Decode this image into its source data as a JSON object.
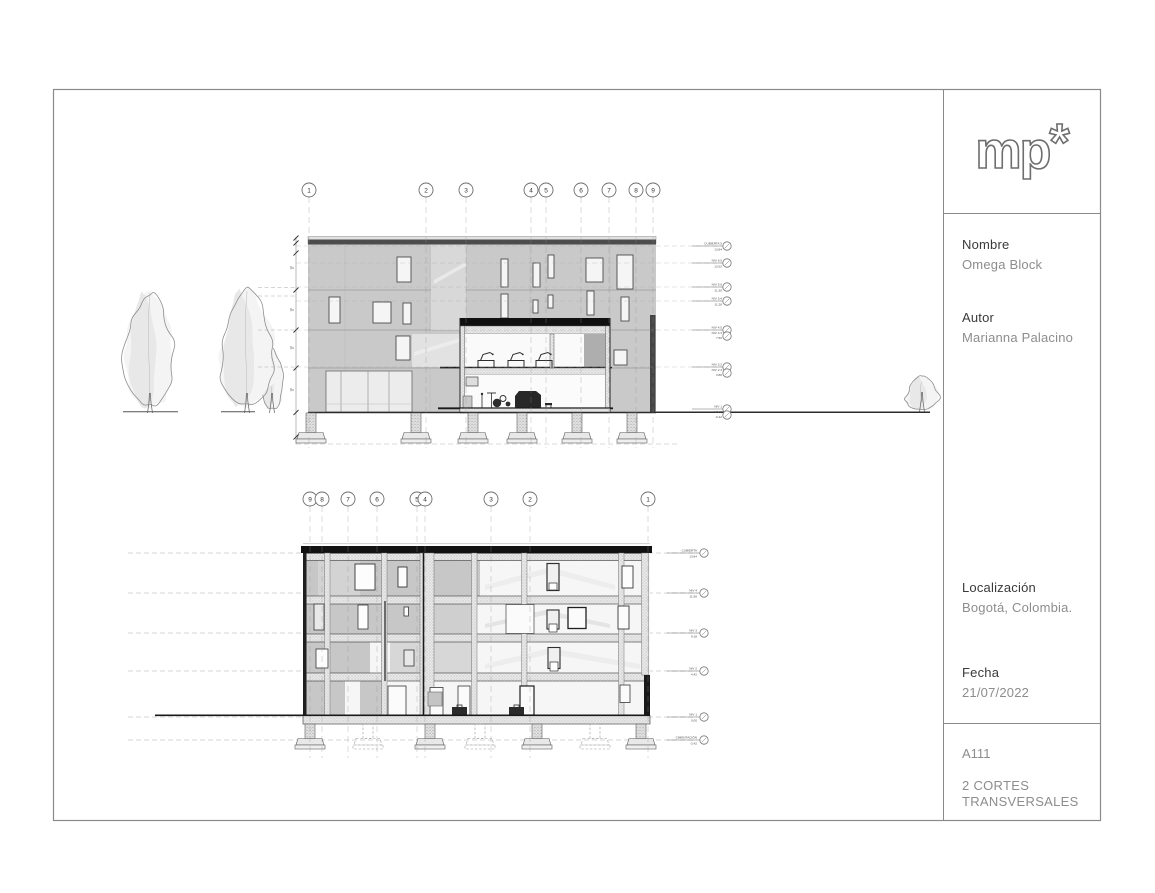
{
  "title_block": {
    "logo_text": "mp",
    "logo_mark": "*",
    "fields": [
      {
        "label": "Nombre",
        "value": "Omega Block"
      },
      {
        "label": "Autor",
        "value": "Marianna Palacino"
      },
      {
        "label": "Localización",
        "value": "Bogotá, Colombia."
      },
      {
        "label": "Fecha",
        "value": "21/07/2022"
      }
    ],
    "sheet_number": "A111",
    "sheet_title": "2 CORTES TRANSVERSALES"
  },
  "sections": {
    "top": {
      "name": "corte transversal 1",
      "grids": [
        {
          "label": "1",
          "x": 309
        },
        {
          "label": "2",
          "x": 426
        },
        {
          "label": "3",
          "x": 466
        },
        {
          "label": "4",
          "x": 531
        },
        {
          "label": "5",
          "x": 546
        },
        {
          "label": "6",
          "x": 581
        },
        {
          "label": "7",
          "x": 609
        },
        {
          "label": "8",
          "x": 636
        },
        {
          "label": "9",
          "x": 653
        }
      ],
      "levels": [
        {
          "lines": [
            "CUBIERTA 5",
            "13.84"
          ],
          "y": 246
        },
        {
          "lines": [
            "NIV 6.5",
            "13.02"
          ],
          "y": 263
        },
        {
          "lines": [
            "NIV 5.6",
            "11.30"
          ],
          "y": 287
        },
        {
          "lines": [
            "NIV 5.4",
            "11.28"
          ],
          "y": 301
        },
        {
          "lines": [
            "NIV 4.5",
            "NIV 4.3",
            "7.56"
          ],
          "y": 330,
          "double": true
        },
        {
          "lines": [
            "NIV 3.2",
            "NIV 2.3",
            "3.88"
          ],
          "y": 367,
          "double": true
        },
        {
          "lines": [
            "NIV 1",
            "NIV 0",
            "-0.42"
          ],
          "y": 409,
          "double": true,
          "no_span": true
        }
      ]
    },
    "bottom": {
      "name": "corte transversal 2",
      "grids": [
        {
          "label": "9",
          "x": 310
        },
        {
          "label": "8",
          "x": 322
        },
        {
          "label": "7",
          "x": 348
        },
        {
          "label": "6",
          "x": 377
        },
        {
          "label": "5",
          "x": 417
        },
        {
          "label": "4",
          "x": 425
        },
        {
          "label": "3",
          "x": 491
        },
        {
          "label": "2",
          "x": 530
        },
        {
          "label": "1",
          "x": 648
        }
      ],
      "levels": [
        {
          "lines": [
            "CUBIERTA",
            "13.84"
          ],
          "y": 553
        },
        {
          "lines": [
            "NIV 4",
            "11.90"
          ],
          "y": 593
        },
        {
          "lines": [
            "NIV 3",
            "9.18"
          ],
          "y": 633
        },
        {
          "lines": [
            "NIV 2",
            "4.42"
          ],
          "y": 671
        },
        {
          "lines": [
            "NIV 1",
            "0.00"
          ],
          "y": 717
        },
        {
          "lines": [
            "CIMENTACIÓN",
            "-2.42"
          ],
          "y": 740
        }
      ]
    }
  }
}
